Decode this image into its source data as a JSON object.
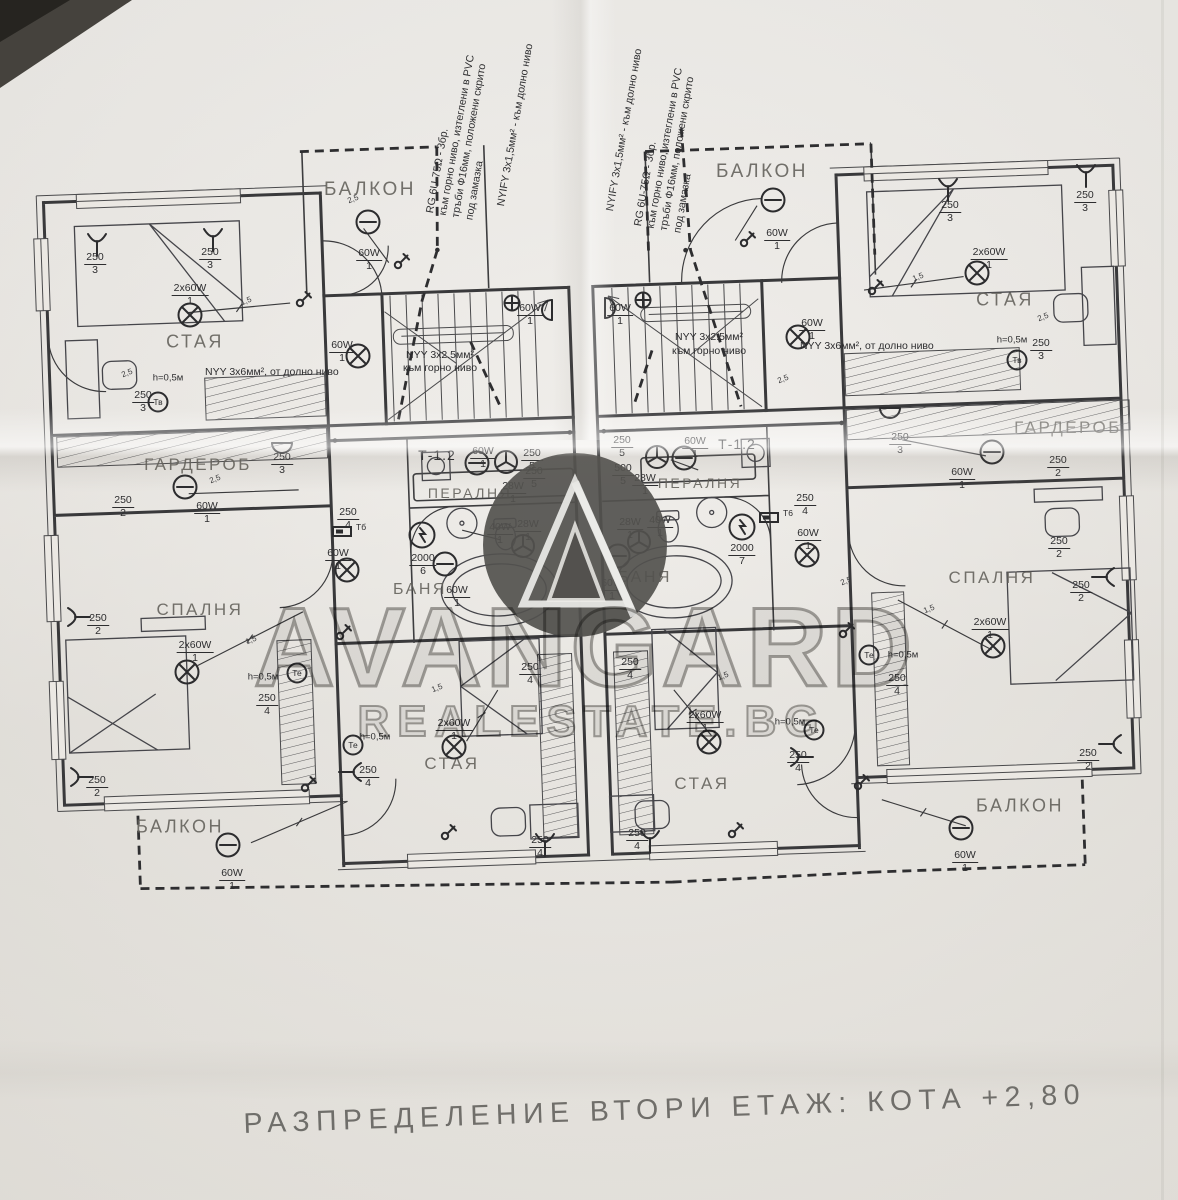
{
  "caption": {
    "text": "РАЗПРЕДЕЛЕНИЕ ВТОРИ ЕТАЖ:  КОТА +2,80"
  },
  "watermark": {
    "brand": "AVANGARD",
    "site": "REALESTATE.BG"
  },
  "cable_notes": {
    "left_rg": {
      "lines": [
        "RG 6U-75Ω - 3бр.",
        "към горно ниво, изтеглени в PVC",
        "тръби Ф16мм, положени скрито",
        "под замазка"
      ]
    },
    "left_nyify": {
      "lines": [
        "NYIFY 3x1,5мм² - към долно ниво"
      ]
    },
    "right_nyify": {
      "lines": [
        "NYIFY 3x1,5мм² - към долно ниво"
      ]
    },
    "right_rg": {
      "lines": [
        "RG 6U-75Ω - 3бр.",
        "към горно ниво, изтеглени в PVC",
        "тръби Ф16мм, положени скрито",
        "под замазка"
      ]
    }
  },
  "rooms": [
    {
      "name": "БАЛКОН",
      "x": 370,
      "y": 190,
      "size": 19
    },
    {
      "name": "БАЛКОН",
      "x": 762,
      "y": 172,
      "size": 19
    },
    {
      "name": "СТАЯ",
      "x": 195,
      "y": 342,
      "size": 18
    },
    {
      "name": "СТАЯ",
      "x": 1005,
      "y": 300,
      "size": 18
    },
    {
      "name": "ГАРДЕРОБ",
      "x": 198,
      "y": 465,
      "size": 17
    },
    {
      "name": "ГАРДЕРОБ",
      "x": 1068,
      "y": 428,
      "size": 17
    },
    {
      "name": "ПЕРАЛНЯ",
      "x": 470,
      "y": 493,
      "size": 14
    },
    {
      "name": "ПЕРАЛНЯ",
      "x": 700,
      "y": 483,
      "size": 14
    },
    {
      "name": "БАНЯ",
      "x": 420,
      "y": 590,
      "size": 16
    },
    {
      "name": "БАНЯ",
      "x": 645,
      "y": 578,
      "size": 16
    },
    {
      "name": "СПАЛНЯ",
      "x": 200,
      "y": 610,
      "size": 17
    },
    {
      "name": "СПАЛНЯ",
      "x": 992,
      "y": 578,
      "size": 17
    },
    {
      "name": "СТАЯ",
      "x": 452,
      "y": 764,
      "size": 17
    },
    {
      "name": "СТАЯ",
      "x": 702,
      "y": 784,
      "size": 17
    },
    {
      "name": "БАЛКОН",
      "x": 180,
      "y": 827,
      "size": 18
    },
    {
      "name": "БАЛКОН",
      "x": 1020,
      "y": 806,
      "size": 18
    }
  ],
  "panel_labels": [
    {
      "text": "Т-1.2",
      "x": 437,
      "y": 455
    },
    {
      "text": "Т-1.2",
      "x": 737,
      "y": 444
    }
  ],
  "wire_notes": [
    {
      "text": "NYY 3x6мм², от долно ниво",
      "x": 205,
      "y": 372
    },
    {
      "text": "NYY 3x6мм², от долно ниво",
      "x": 800,
      "y": 346
    },
    {
      "text": "NYY 3x2.5мм²",
      "x": 406,
      "y": 355
    },
    {
      "text": "към горно ниво",
      "x": 403,
      "y": 368
    },
    {
      "text": "NYY 3x2.5мм²",
      "x": 675,
      "y": 337
    },
    {
      "text": "към горно ниво",
      "x": 672,
      "y": 351
    }
  ],
  "height_marks": [
    {
      "text": "h=0,5м",
      "x": 168,
      "y": 378
    },
    {
      "text": "h=0,5м",
      "x": 1012,
      "y": 340
    },
    {
      "text": "h=0,5м",
      "x": 263,
      "y": 677
    },
    {
      "text": "h=0,5м",
      "x": 375,
      "y": 737
    },
    {
      "text": "h=0,5м",
      "x": 903,
      "y": 655
    },
    {
      "text": "h=0,5м",
      "x": 790,
      "y": 722
    }
  ],
  "size_marks": [
    {
      "text": "1,5",
      "x": 246,
      "y": 301
    },
    {
      "text": "1,5",
      "x": 918,
      "y": 277
    },
    {
      "text": "2,5",
      "x": 127,
      "y": 373
    },
    {
      "text": "2,5",
      "x": 353,
      "y": 199
    },
    {
      "text": "1,5",
      "x": 251,
      "y": 640
    },
    {
      "text": "1,5",
      "x": 929,
      "y": 609
    },
    {
      "text": "1,5",
      "x": 437,
      "y": 688
    },
    {
      "text": "1,5",
      "x": 723,
      "y": 676
    },
    {
      "text": "2,5",
      "x": 1043,
      "y": 317
    },
    {
      "text": "2,5",
      "x": 846,
      "y": 581
    },
    {
      "text": "2,5",
      "x": 215,
      "y": 479
    },
    {
      "text": "2,5",
      "x": 783,
      "y": 379
    }
  ],
  "fixture_labels": [
    {
      "t": "250",
      "b": "3",
      "x": 95,
      "y": 252
    },
    {
      "t": "250",
      "b": "3",
      "x": 210,
      "y": 247
    },
    {
      "t": "2x60W",
      "b": "1",
      "x": 190,
      "y": 283
    },
    {
      "t": "250",
      "b": "3",
      "x": 143,
      "y": 390
    },
    {
      "t": "60W",
      "b": "1",
      "x": 342,
      "y": 340
    },
    {
      "t": "60W",
      "b": "1",
      "x": 530,
      "y": 303
    },
    {
      "t": "60W",
      "b": "1",
      "x": 620,
      "y": 303
    },
    {
      "t": "60W",
      "b": "1",
      "x": 369,
      "y": 248
    },
    {
      "t": "60W",
      "b": "1",
      "x": 777,
      "y": 228
    },
    {
      "t": "60W",
      "b": "1",
      "x": 812,
      "y": 318
    },
    {
      "t": "250",
      "b": "3",
      "x": 950,
      "y": 200
    },
    {
      "t": "250",
      "b": "3",
      "x": 1085,
      "y": 190
    },
    {
      "t": "2x60W",
      "b": "1",
      "x": 989,
      "y": 247
    },
    {
      "t": "250",
      "b": "3",
      "x": 1041,
      "y": 338
    },
    {
      "t": "60W",
      "b": "1",
      "x": 207,
      "y": 501
    },
    {
      "t": "250",
      "b": "2",
      "x": 123,
      "y": 495
    },
    {
      "t": "250",
      "b": "3",
      "x": 282,
      "y": 452
    },
    {
      "t": "60W",
      "b": "1",
      "x": 962,
      "y": 467
    },
    {
      "t": "250",
      "b": "2",
      "x": 1058,
      "y": 455
    },
    {
      "t": "250",
      "b": "3",
      "x": 900,
      "y": 432
    },
    {
      "t": "60W",
      "b": "1",
      "x": 483,
      "y": 446
    },
    {
      "t": "250",
      "b": "5",
      "x": 532,
      "y": 448
    },
    {
      "t": "250",
      "b": "5",
      "x": 534,
      "y": 466
    },
    {
      "t": "28W",
      "b": "1",
      "x": 513,
      "y": 481
    },
    {
      "t": "40W",
      "b": "1",
      "x": 500,
      "y": 522
    },
    {
      "t": "28W",
      "b": "1",
      "x": 528,
      "y": 519
    },
    {
      "t": "2000",
      "b": "6",
      "x": 423,
      "y": 553
    },
    {
      "t": "60W",
      "b": "1",
      "x": 457,
      "y": 585
    },
    {
      "t": "60W",
      "b": "1",
      "x": 695,
      "y": 436
    },
    {
      "t": "250",
      "b": "5",
      "x": 622,
      "y": 435
    },
    {
      "t": "500",
      "b": "5",
      "x": 623,
      "y": 463
    },
    {
      "t": "28W",
      "b": "1",
      "x": 645,
      "y": 473
    },
    {
      "t": "40W",
      "b": "1",
      "x": 660,
      "y": 515
    },
    {
      "t": "28W",
      "b": "1",
      "x": 630,
      "y": 517
    },
    {
      "t": "2000",
      "b": "7",
      "x": 742,
      "y": 543
    },
    {
      "t": "60W",
      "b": "1",
      "x": 612,
      "y": 578
    },
    {
      "t": "250",
      "b": "4",
      "x": 348,
      "y": 507
    },
    {
      "t": "60W",
      "b": "1",
      "x": 338,
      "y": 548
    },
    {
      "t": "250",
      "b": "4",
      "x": 805,
      "y": 493
    },
    {
      "t": "60W",
      "b": "1",
      "x": 808,
      "y": 528
    },
    {
      "t": "250",
      "b": "2",
      "x": 98,
      "y": 613
    },
    {
      "t": "2x60W",
      "b": "1",
      "x": 195,
      "y": 640
    },
    {
      "t": "250",
      "b": "4",
      "x": 267,
      "y": 693
    },
    {
      "t": "250",
      "b": "2",
      "x": 97,
      "y": 775
    },
    {
      "t": "250",
      "b": "2",
      "x": 1059,
      "y": 536
    },
    {
      "t": "250",
      "b": "2",
      "x": 1081,
      "y": 580
    },
    {
      "t": "2x60W",
      "b": "1",
      "x": 990,
      "y": 617
    },
    {
      "t": "250",
      "b": "4",
      "x": 897,
      "y": 673
    },
    {
      "t": "250",
      "b": "2",
      "x": 1088,
      "y": 748
    },
    {
      "t": "2x60W",
      "b": "1",
      "x": 454,
      "y": 718
    },
    {
      "t": "250",
      "b": "4",
      "x": 530,
      "y": 662
    },
    {
      "t": "250",
      "b": "4",
      "x": 368,
      "y": 765
    },
    {
      "t": "250",
      "b": "4",
      "x": 540,
      "y": 835
    },
    {
      "t": "2x60W",
      "b": "1",
      "x": 705,
      "y": 710
    },
    {
      "t": "250",
      "b": "4",
      "x": 630,
      "y": 657
    },
    {
      "t": "250",
      "b": "4",
      "x": 798,
      "y": 750
    },
    {
      "t": "250",
      "b": "4",
      "x": 637,
      "y": 828
    },
    {
      "t": "60W",
      "b": "1",
      "x": 232,
      "y": 868
    },
    {
      "t": "60W",
      "b": "1",
      "x": 965,
      "y": 850
    }
  ],
  "symbols": {
    "ceiling_lamps": [
      {
        "x": 190,
        "y": 315
      },
      {
        "x": 977,
        "y": 273
      },
      {
        "x": 187,
        "y": 672
      },
      {
        "x": 993,
        "y": 646
      },
      {
        "x": 454,
        "y": 747
      },
      {
        "x": 709,
        "y": 742
      },
      {
        "x": 347,
        "y": 570
      },
      {
        "x": 807,
        "y": 555
      },
      {
        "x": 358,
        "y": 356
      },
      {
        "x": 798,
        "y": 337
      }
    ],
    "wall_lamps": [
      {
        "x": 368,
        "y": 222
      },
      {
        "x": 773,
        "y": 200
      },
      {
        "x": 185,
        "y": 487
      },
      {
        "x": 992,
        "y": 452
      },
      {
        "x": 228,
        "y": 845
      },
      {
        "x": 961,
        "y": 828
      },
      {
        "x": 477,
        "y": 463
      },
      {
        "x": 684,
        "y": 458
      },
      {
        "x": 445,
        "y": 564
      },
      {
        "x": 618,
        "y": 556
      }
    ],
    "sconces": [
      {
        "x": 552,
        "y": 310,
        "rot": 180
      },
      {
        "x": 605,
        "y": 308,
        "rot": 0
      },
      {
        "x": 282,
        "y": 443,
        "rot": 90
      },
      {
        "x": 890,
        "y": 408,
        "rot": 90
      }
    ],
    "bed_lamps": [
      {
        "x": 97,
        "y": 243,
        "rot": 0
      },
      {
        "x": 213,
        "y": 238,
        "rot": 0
      },
      {
        "x": 948,
        "y": 188,
        "rot": 0
      },
      {
        "x": 1086,
        "y": 174,
        "rot": 0
      },
      {
        "x": 77,
        "y": 617,
        "rot": 270
      },
      {
        "x": 80,
        "y": 777,
        "rot": 270
      },
      {
        "x": 1105,
        "y": 577,
        "rot": 90
      },
      {
        "x": 1112,
        "y": 744,
        "rot": 90
      },
      {
        "x": 352,
        "y": 772,
        "rot": 90
      },
      {
        "x": 545,
        "y": 843,
        "rot": 0
      },
      {
        "x": 800,
        "y": 757,
        "rot": 270
      },
      {
        "x": 650,
        "y": 840,
        "rot": 0
      }
    ],
    "fans": [
      {
        "x": 506,
        "y": 462
      },
      {
        "x": 523,
        "y": 546
      },
      {
        "x": 657,
        "y": 457
      },
      {
        "x": 639,
        "y": 542
      }
    ],
    "boilers": [
      {
        "x": 422,
        "y": 535
      },
      {
        "x": 742,
        "y": 527
      }
    ],
    "junctions": [
      {
        "x": 512,
        "y": 303
      },
      {
        "x": 643,
        "y": 300
      }
    ],
    "switches": [
      {
        "x": 300,
        "y": 303
      },
      {
        "x": 872,
        "y": 291
      },
      {
        "x": 340,
        "y": 636
      },
      {
        "x": 843,
        "y": 634
      },
      {
        "x": 305,
        "y": 788
      },
      {
        "x": 858,
        "y": 786
      },
      {
        "x": 445,
        "y": 836
      },
      {
        "x": 732,
        "y": 834
      },
      {
        "x": 398,
        "y": 265
      },
      {
        "x": 744,
        "y": 243
      }
    ],
    "low_outlets": [
      {
        "x": 158,
        "y": 402,
        "label": "Тв"
      },
      {
        "x": 1017,
        "y": 360,
        "label": "Тв"
      },
      {
        "x": 297,
        "y": 673,
        "label": "Те"
      },
      {
        "x": 353,
        "y": 745,
        "label": "Те"
      },
      {
        "x": 869,
        "y": 655,
        "label": "Те"
      },
      {
        "x": 814,
        "y": 730,
        "label": "Те"
      }
    ],
    "terminal_boxes": [
      {
        "x": 356,
        "y": 531,
        "label": "Тб"
      },
      {
        "x": 783,
        "y": 517,
        "label": "Т6"
      }
    ]
  }
}
